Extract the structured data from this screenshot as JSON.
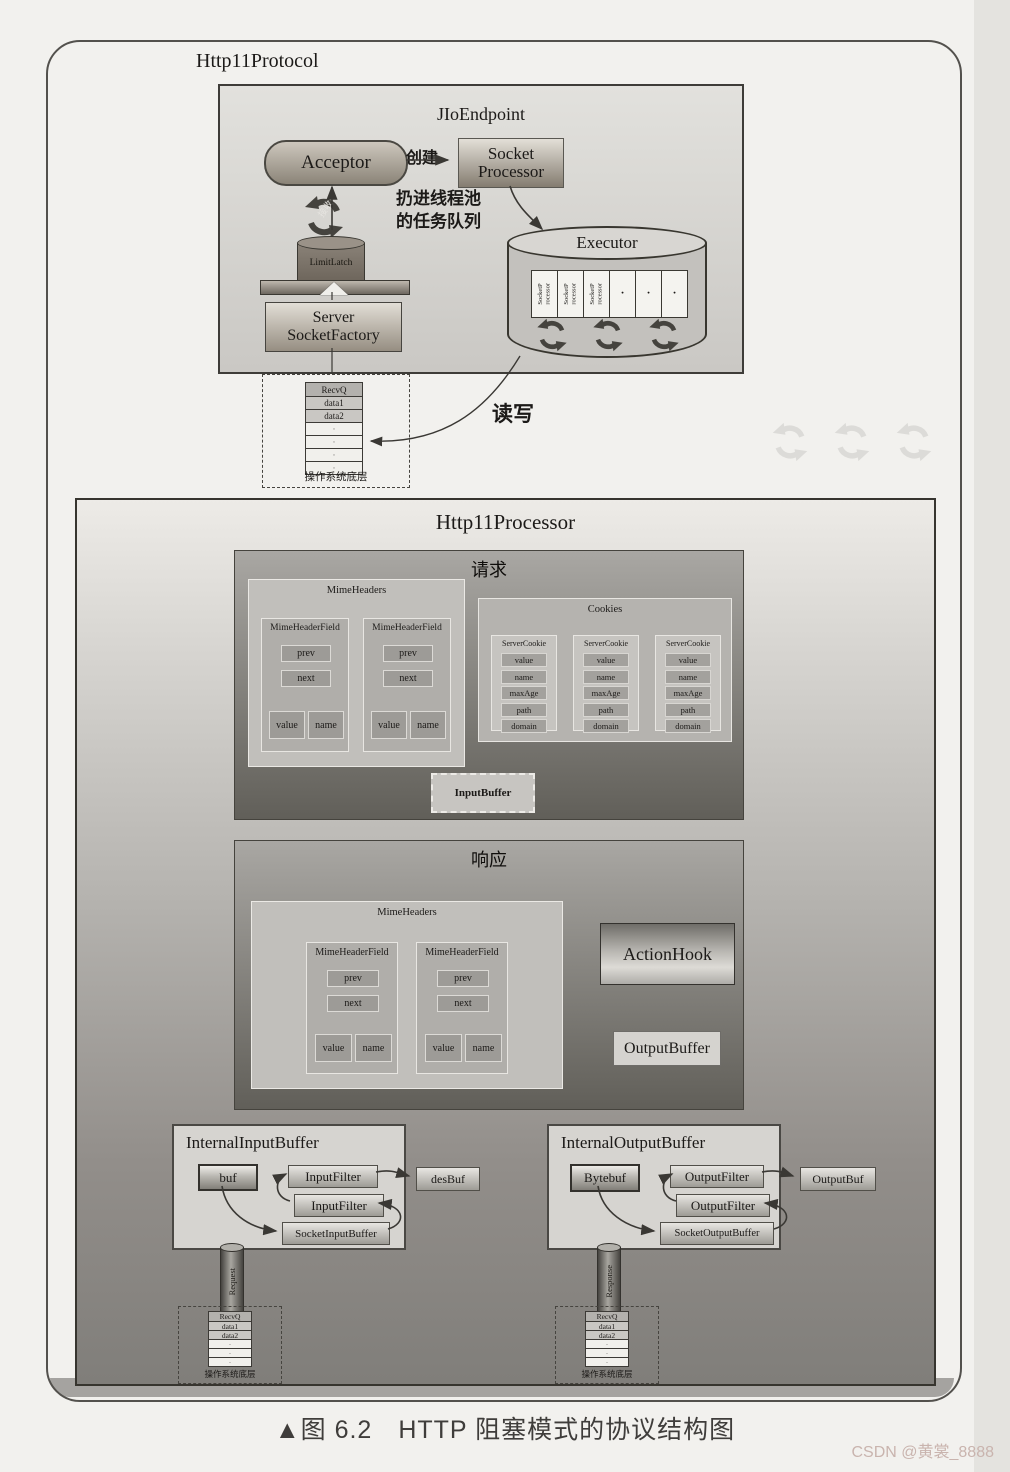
{
  "page": {
    "caption": "▲图 6.2　HTTP 阻塞模式的协议结构图",
    "watermark": "CSDN @黄裳_8888"
  },
  "protocol": {
    "title": "Http11Protocol",
    "endpoint": "JIoEndpoint",
    "acceptor": "Acceptor",
    "create": "创建",
    "socket_processor": "Socket\nProcessor",
    "pool_note": "扔进线程池\n的任务队列",
    "accept": "接收",
    "limit_latch": "LimitLatch",
    "server_socket_factory": "Server\nSocketFactory",
    "executor": {
      "title": "Executor",
      "cell": "SocketP\nrocessor",
      "dot": "·"
    },
    "read_write": "读写",
    "os_queue": {
      "head": "RecvQ",
      "rows": [
        "data1",
        "data2"
      ],
      "dot": "·",
      "label": "操作系统底层"
    }
  },
  "processor": {
    "title": "Http11Processor",
    "request": {
      "title": "请求",
      "mime_headers": "MimeHeaders",
      "field": {
        "title": "MimeHeaderField",
        "prev": "prev",
        "next": "next",
        "value": "value",
        "name": "name"
      },
      "cookies": {
        "title": "Cookies",
        "cookie": "ServerCookie",
        "rows": [
          "value",
          "name",
          "maxAge",
          "path",
          "domain"
        ]
      },
      "input_buffer": "InputBuffer"
    },
    "response": {
      "title": "响应",
      "mime_headers": "MimeHeaders",
      "action_hook": "ActionHook",
      "output_buffer": "OutputBuffer"
    },
    "input_side": {
      "title": "InternalInputBuffer",
      "buf": "buf",
      "filter": "InputFilter",
      "socket_buffer": "SocketInputBuffer",
      "dest": "desBuf",
      "pipe": "Request"
    },
    "output_side": {
      "title": "InternalOutputBuffer",
      "buf": "Bytebuf",
      "filter": "OutputFilter",
      "socket_buffer": "SocketOutputBuffer",
      "dest": "OutputBuf",
      "pipe": "Response"
    },
    "os_queue": {
      "head": "RecvQ",
      "rows": [
        "data1",
        "data2"
      ],
      "dot": "·",
      "label": "操作系统底层"
    }
  }
}
